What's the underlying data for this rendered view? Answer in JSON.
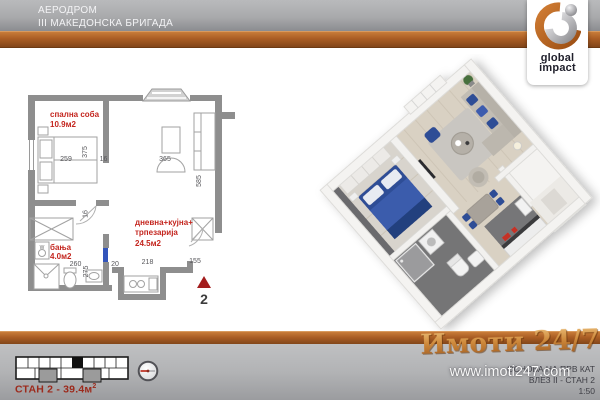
{
  "header": {
    "line1": "АЕРОДРОМ",
    "line2": "III МАКЕДОНСКА БРИГАДА"
  },
  "logo": {
    "word1": "global",
    "word2": "impact"
  },
  "plan2d": {
    "rooms": {
      "bedroom": {
        "name": "спална соба",
        "area": "10.9м2"
      },
      "living": {
        "name_line1": "дневна+кујна+",
        "name_line2": "трпезарија",
        "area": "24.5м2"
      },
      "bath": {
        "name": "бања",
        "area": "4.0м2"
      }
    },
    "dims": {
      "bedroom_w": "259",
      "bedroom_h": "375",
      "wall_a": "16",
      "living_w": "365",
      "living_h": "585",
      "hall_t": "16",
      "bath_w": "260",
      "bath_h": "275",
      "bath_door": "20",
      "kitchen_w": "218",
      "entry_w": "155"
    },
    "washer_label": "W",
    "entrance_number": "2"
  },
  "footer": {
    "unit_label": "СТАН 2 - 39.4м",
    "unit_label_sup": "2",
    "watermark": "Имоти 24/7",
    "website": "www.imoti247.com",
    "doc_line1": "ОСНОВА НА ПРВ КАТ",
    "doc_line2": "ВЛЕЗ II - СТАН 2",
    "doc_scale": "1:50"
  },
  "colors": {
    "accent_orange": "#aa5d24",
    "header_gray": "#a9aaac",
    "plan_wall_gray": "#8e8e8e",
    "label_red": "#c4261f",
    "entrance_red": "#a31d1d",
    "unit_label_red": "#9c2a1c",
    "furniture_blue": "#2f4e96",
    "watermark_tan": "#cf8a3c"
  }
}
